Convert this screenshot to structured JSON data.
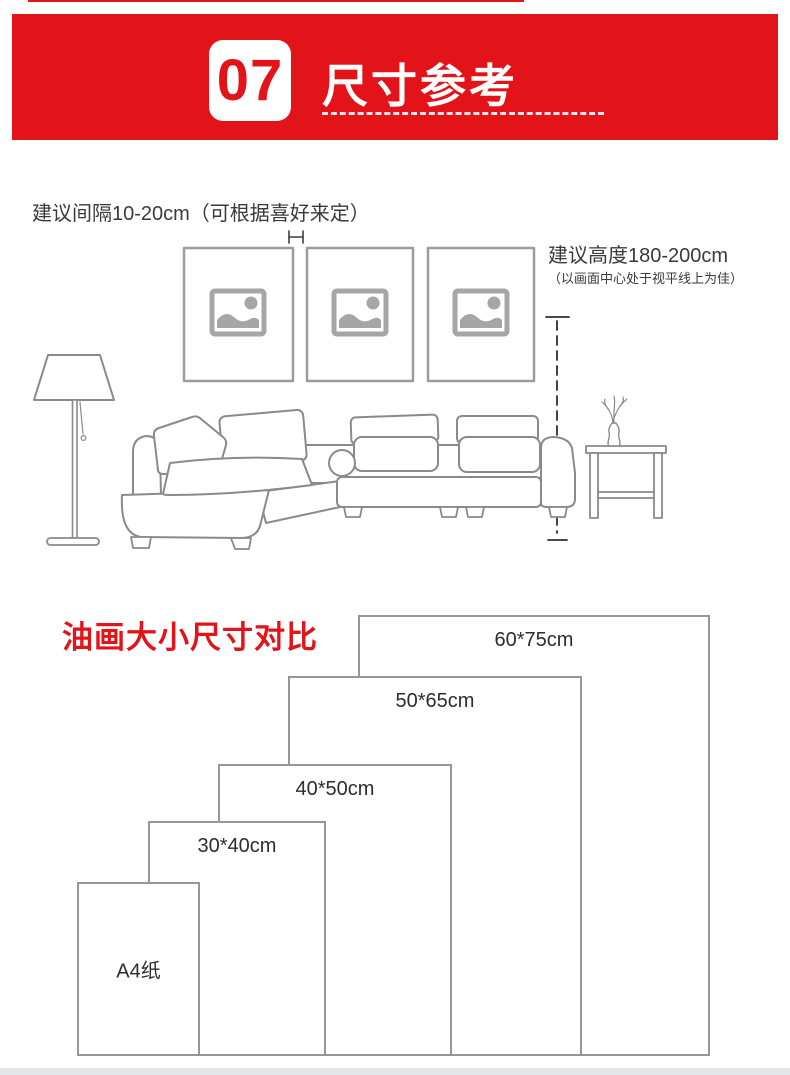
{
  "header": {
    "badge_number": "07",
    "title": "尺寸参考"
  },
  "hanging_guide": {
    "spacing_note": "建议间隔10-20cm（可根据喜好来定）",
    "height_note_title": "建议高度180-200cm",
    "height_note_sub": "（以画面中心处于视平线上为佳）"
  },
  "size_chart": {
    "title": "油画大小尺寸对比",
    "sizes": [
      {
        "label": "60*75cm"
      },
      {
        "label": "50*65cm"
      },
      {
        "label": "40*50cm"
      },
      {
        "label": "30*40cm"
      },
      {
        "label": "A4纸"
      }
    ]
  },
  "colors": {
    "accent_red": "#e2141a",
    "illustration_line_gray": "#8a8a8a",
    "chart_border_gray": "#95979a",
    "text_dark": "#3a3a3a",
    "placeholder_icon_gray": "#a6a6a6"
  }
}
